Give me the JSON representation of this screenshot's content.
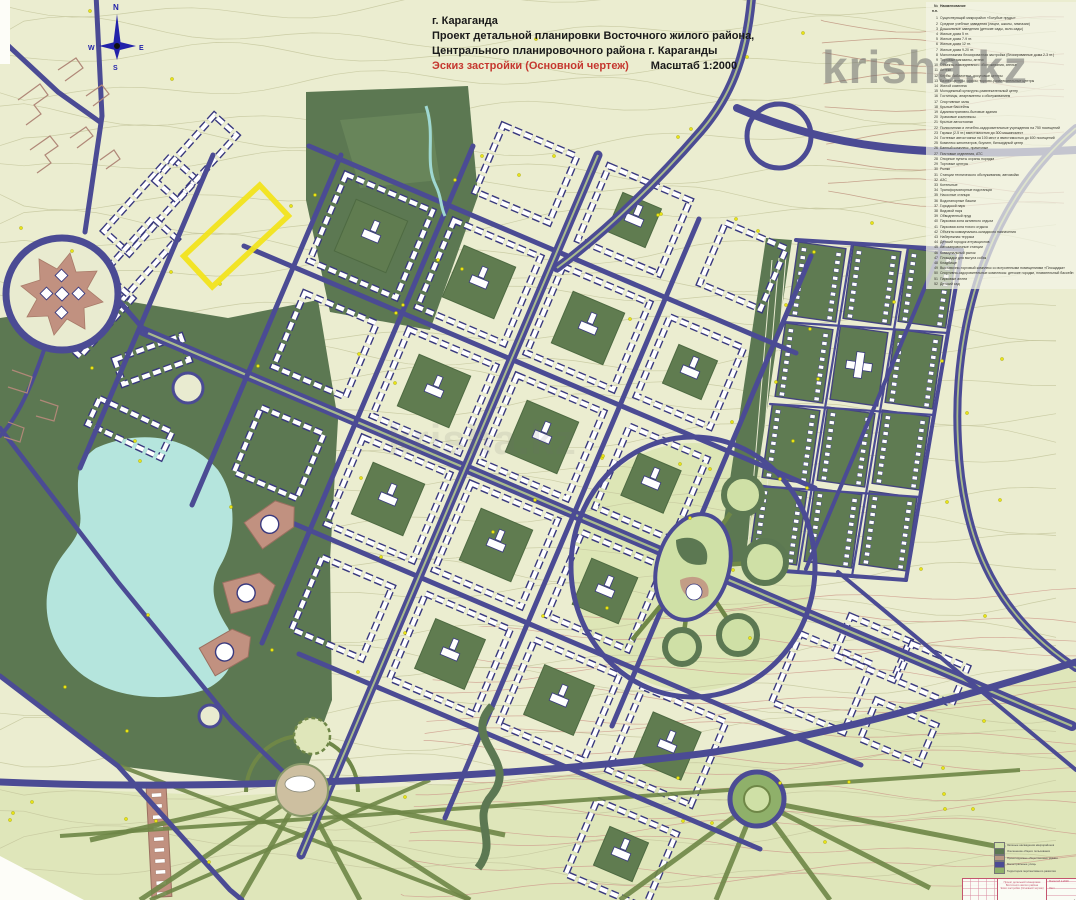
{
  "title_block": {
    "city": "г. Караганда",
    "line1": "Проект детальной планировки Восточного жилого района,",
    "line2": "Центрального планировочного района г. Караганды",
    "subtitle_red": "Эскиз застройки (Основной чертеж)",
    "scale": "Масштаб 1:2000"
  },
  "watermark": {
    "text": "krisha.kz"
  },
  "compass": {
    "n": "N",
    "s": "S",
    "w": "W",
    "e": "E"
  },
  "legend": {
    "header_num": "№ п.п.",
    "header_name": "Наименование",
    "items": [
      {
        "num": "1",
        "label": "Существующий микрорайон «Голубые пруды»"
      },
      {
        "num": "2",
        "label": "Средние учебные заведения (лицеи, школы, гимназии)"
      },
      {
        "num": "3",
        "label": "Дошкольные заведения (детские сады, ясли-сады)"
      },
      {
        "num": "4",
        "label": "Жилые дома 5 эт."
      },
      {
        "num": "5",
        "label": "Жилые дома 7-9 эт."
      },
      {
        "num": "6",
        "label": "Жилые дома 12 эт."
      },
      {
        "num": "7",
        "label": "Жилые дома 9-20 эт."
      },
      {
        "num": "8",
        "label": "Малоэтажная блокированная застройка (блокированные дома 2-3 эт.)"
      },
      {
        "num": "9",
        "label": "Торговые магазины, аптеки"
      },
      {
        "num": "10",
        "label": "Объекты повседневного обслуживания, ателье"
      },
      {
        "num": "11",
        "label": "Аптеки"
      },
      {
        "num": "12",
        "label": "Клубы, библиотеки, досуговые центры"
      },
      {
        "num": "13",
        "label": "Бизнес-центры, офисы, торгово-развлекательные центры"
      },
      {
        "num": "14",
        "label": "Жилой комплекс"
      },
      {
        "num": "15",
        "label": "Молодежный культурно-развлекательный центр"
      },
      {
        "num": "16",
        "label": "Гостиницы, апартаменты с обслуживанием"
      },
      {
        "num": "17",
        "label": "Спортивные залы"
      },
      {
        "num": "18",
        "label": "Крытые бассейны"
      },
      {
        "num": "19",
        "label": "Административно-бытовые здания"
      },
      {
        "num": "20",
        "label": "Храмовые комплексы"
      },
      {
        "num": "21",
        "label": "Крытые автостоянки"
      },
      {
        "num": "22",
        "label": "Поликлиники и лечебно-оздоровительные учреждения на 750 посещений"
      },
      {
        "num": "23",
        "label": "Гаражи (2-5 эт.) вместимостью до 300 машиномест"
      },
      {
        "num": "24",
        "label": "Гостевые автостоянки на 100 мест и вместимостью до 600 посещений"
      },
      {
        "num": "25",
        "label": "Комплекс кинотеатров, боулинг, бильярдный центр"
      },
      {
        "num": "26",
        "label": "Банный комплекс, прачечные"
      },
      {
        "num": "27",
        "label": "Почтовые отделения, АТС"
      },
      {
        "num": "28",
        "label": "Опорные пункты охраны порядка"
      },
      {
        "num": "29",
        "label": "Торговые центры"
      },
      {
        "num": "30",
        "label": "Рынки"
      },
      {
        "num": "31",
        "label": "Станции технического обслуживания, автомойки"
      },
      {
        "num": "32",
        "label": "АЗС"
      },
      {
        "num": "33",
        "label": "Котельные"
      },
      {
        "num": "34",
        "label": "Трансформаторные подстанции"
      },
      {
        "num": "35",
        "label": "Насосные станции"
      },
      {
        "num": "36",
        "label": "Водонапорные башни"
      },
      {
        "num": "37",
        "label": "Городской парк"
      },
      {
        "num": "38",
        "label": "Видовой парк"
      },
      {
        "num": "39",
        "label": "Обводненный пруд"
      },
      {
        "num": "40",
        "label": "Парковая зона активного отдыха"
      },
      {
        "num": "41",
        "label": "Парковая зона тихого отдыха"
      },
      {
        "num": "42",
        "label": "Объекты коммунально-складского назначения"
      },
      {
        "num": "43",
        "label": "Набережная терраса"
      },
      {
        "num": "44",
        "label": "Детский городок аттракционов"
      },
      {
        "num": "45",
        "label": "Автозаправочные станции"
      },
      {
        "num": "46",
        "label": "Коммунальный рынок"
      },
      {
        "num": "47",
        "label": "Площадки для выгула собак"
      },
      {
        "num": "48",
        "label": "Кладбище"
      },
      {
        "num": "49",
        "label": "Выставочно-торговый комплекс со встроенными помещениями «Площадка»"
      },
      {
        "num": "50",
        "label": "Спортивно-оздоровительные комплексы: детские городки, плавательный бассейн"
      },
      {
        "num": "51",
        "label": "Парковые аллеи"
      },
      {
        "num": "52",
        "label": "Детский сад"
      }
    ]
  },
  "mini_legend": {
    "items": [
      {
        "color": "#cfe0a6",
        "label": "Зеленые насаждения микрорайонов"
      },
      {
        "color": "#5c7852",
        "label": "Озеленение общего пользования"
      },
      {
        "color": "#b99884",
        "label": "Проектируемые общественные здания"
      },
      {
        "color": "#4b4b94",
        "label": "Магистральные улицы"
      },
      {
        "color": "#8fb06a",
        "label": "Территория перспективного развития"
      }
    ]
  },
  "stamp": {
    "project": "Проект детальной планировки Восточного жилого района",
    "stage": "Эскиз застройки (Основной чертеж)",
    "scale_label": "Масштаб 1:2000",
    "sheet_label": "Лист"
  },
  "colors": {
    "background": "#ebedd0",
    "contour": "#c6c79e",
    "contour_brown": "#cf9e8e",
    "road": "#4b4b94",
    "park_dark": "#5c7852",
    "park_light": "#dfe6ba",
    "grass_circle": "#cfe0a6",
    "lake": "#b5e5dd",
    "terracotta": "#c19180",
    "building_outline": "#39397e",
    "highlight": "#f2e41c",
    "title_red": "#c5372f",
    "stamp_red": "#c4556e",
    "dot_yellow": "#e9e414"
  }
}
